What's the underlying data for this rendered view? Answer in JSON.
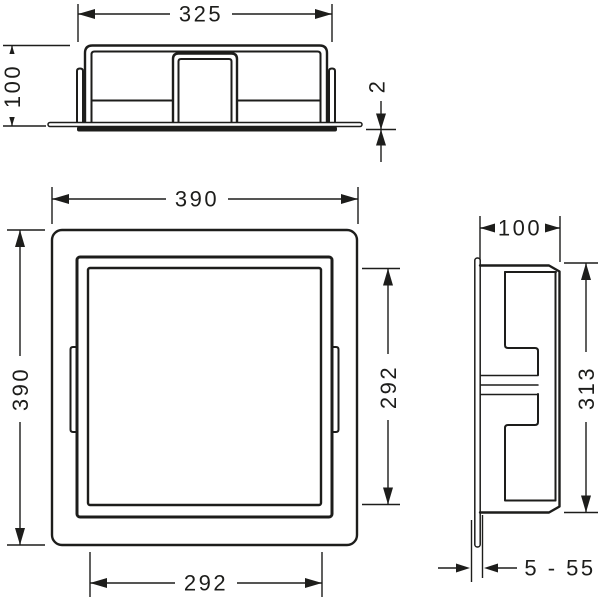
{
  "drawing": {
    "background_color": "#ffffff",
    "line_color": "#1d1d1b",
    "views": {
      "top": {
        "dims": {
          "width": "325",
          "depth": "100",
          "flange_thickness": "2"
        }
      },
      "front": {
        "dims": {
          "outer_width": "390",
          "outer_height": "390",
          "opening_height": "292",
          "opening_width": "292"
        }
      },
      "side": {
        "dims": {
          "depth": "100",
          "height": "313",
          "tile_range": "5 - 55"
        }
      }
    }
  }
}
